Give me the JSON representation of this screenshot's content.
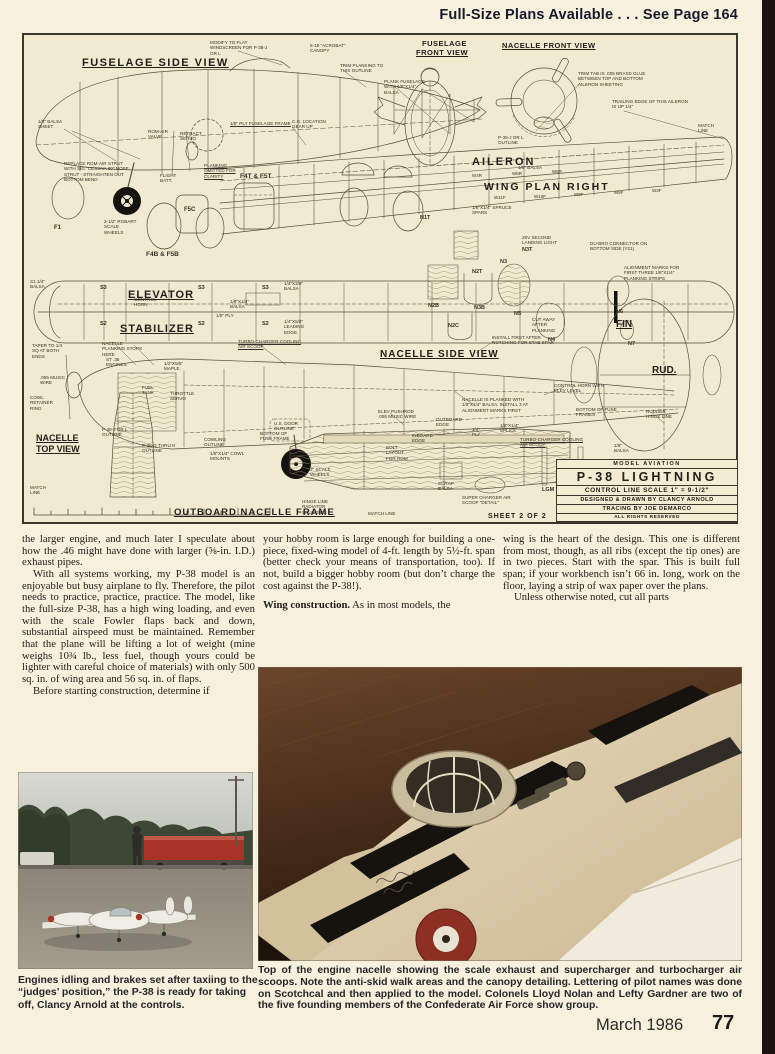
{
  "header": {
    "note": "Full-Size Plans Available . . . See Page 164"
  },
  "footer": {
    "issue": "March 1986",
    "page_number": "77"
  },
  "colors": {
    "page_bg": "#f6f0dc",
    "plan_bg": "#f1ead0",
    "accent_red": "#a93227",
    "edge_bar": "#1a120e",
    "ink": "#23201a"
  },
  "plan": {
    "sheet_label": "SHEET 2 OF 2",
    "title_block": {
      "magazine": "MODEL AVIATION",
      "model": "P-38 LIGHTNING",
      "scale": "CONTROL LINE SCALE  1\" = 9-1/2\"",
      "designer": "DESIGNED & DRAWN BY CLANCY ARNOLD",
      "tracing": "TRACING BY JOE DEMARCO",
      "rights": "ALL RIGHTS RESERVED"
    },
    "titles": [
      {
        "t": "FUSELAGE SIDE VIEW",
        "x": 58,
        "y": 22,
        "fs": 11,
        "u": 1,
        "ls": 1.5
      },
      {
        "t": "FUSELAGE",
        "x": 398,
        "y": 4,
        "fs": 7.5,
        "ls": 0.5
      },
      {
        "t": "FRONT VIEW",
        "x": 392,
        "y": 13,
        "fs": 7.5,
        "u": 1,
        "ls": 0.5
      },
      {
        "t": "NACELLE FRONT VIEW",
        "x": 478,
        "y": 6,
        "fs": 7.5,
        "u": 1,
        "ls": 0.5
      },
      {
        "t": "AILERON",
        "x": 448,
        "y": 121,
        "fs": 11,
        "ls": 2
      },
      {
        "t": "WING    PLAN    RIGHT",
        "x": 460,
        "y": 146,
        "fs": 10.5,
        "ls": 2
      },
      {
        "t": "ELEVATOR",
        "x": 104,
        "y": 254,
        "fs": 11,
        "u": 1,
        "ls": 1
      },
      {
        "t": "STABILIZER",
        "x": 96,
        "y": 288,
        "fs": 11,
        "u": 1,
        "ls": 1
      },
      {
        "t": "NACELLE SIDE VIEW",
        "x": 356,
        "y": 314,
        "fs": 10,
        "u": 1,
        "ls": 1
      },
      {
        "t": "FIN",
        "x": 592,
        "y": 284,
        "fs": 10,
        "u": 1
      },
      {
        "t": "RUD.",
        "x": 628,
        "y": 330,
        "fs": 10,
        "u": 1
      },
      {
        "t": "NACELLE",
        "x": 12,
        "y": 398,
        "fs": 9,
        "u": 1
      },
      {
        "t": "TOP VIEW",
        "x": 12,
        "y": 409,
        "fs": 9,
        "u": 1
      },
      {
        "t": "OUTBOARD NACELLE FRAME",
        "x": 150,
        "y": 472,
        "fs": 9.5,
        "u": 1,
        "ls": 1
      }
    ],
    "notes": [
      {
        "t": "1/8\" BALSA SHEET",
        "x": 14,
        "y": 84,
        "w": 34
      },
      {
        "t": "MODIFY TO FLAT WINDSCREEN FOR P-38-J OR L",
        "x": 186,
        "y": 5,
        "w": 62
      },
      {
        "t": "5-16 \"ACROBAT\" CANOPY",
        "x": 286,
        "y": 8,
        "w": 44
      },
      {
        "t": "TRIM PLANKING TO THIS OUTLINE",
        "x": 316,
        "y": 28,
        "w": 48
      },
      {
        "t": "PLANK FUSELAGE WITH 1/8\"x1/4\" BALSA",
        "x": 360,
        "y": 44,
        "w": 44
      },
      {
        "t": "ROM-AIR VALVE",
        "x": 124,
        "y": 94,
        "w": 26
      },
      {
        "t": "RETRACT SERVO",
        "x": 156,
        "y": 96,
        "w": 26
      },
      {
        "t": "1/8\" PLY FUSELAGE FRAME",
        "x": 206,
        "y": 86,
        "w": 80,
        "u": 1
      },
      {
        "t": "C.G. LOCATION GEAR UP",
        "x": 268,
        "y": 84,
        "w": 34
      },
      {
        "t": "REPLACE ROM-AIR STRUT WITH SIG \"CESSNA 60\" NOSE STRUT - STRAIGHTEN OUT BOTTOM BEND",
        "x": 40,
        "y": 126,
        "w": 66
      },
      {
        "t": "PLANKING OMITTED FOR CLARITY",
        "x": 180,
        "y": 128,
        "w": 44,
        "u": 1
      },
      {
        "t": "FLIGHT BATT.",
        "x": 136,
        "y": 138,
        "w": 22
      },
      {
        "t": "2-1/2\" ROBART SCALE WHEELS",
        "x": 80,
        "y": 184,
        "w": 34
      },
      {
        "t": "F4T & F5T",
        "x": 216,
        "y": 138,
        "fs": 6.5,
        "b": 1
      },
      {
        "t": "F4B & F5B",
        "x": 122,
        "y": 216,
        "fs": 6.5,
        "b": 1
      },
      {
        "t": "F5C",
        "x": 160,
        "y": 172,
        "fs": 6,
        "b": 1
      },
      {
        "t": "F1",
        "x": 30,
        "y": 190,
        "fs": 6,
        "b": 1
      },
      {
        "t": "TRIM TAB IS .005 BRASS GLUE BETWEEN TOP AND BOTTOM AILERON SHEETING",
        "x": 554,
        "y": 36,
        "w": 78
      },
      {
        "t": "TRAILING EDGE OF THIS AILERON IS UP 1/4\"",
        "x": 588,
        "y": 64,
        "w": 78
      },
      {
        "t": "MATCH LINE",
        "x": 674,
        "y": 88,
        "w": 26
      },
      {
        "t": "P-38-J OR L OUTLINE",
        "x": 474,
        "y": 100,
        "w": 40
      },
      {
        "t": "1/8\" BALSA",
        "x": 494,
        "y": 130,
        "w": 30
      },
      {
        "t": "1/8\"x1/4\" SPRUCE SPARS",
        "x": 448,
        "y": 170,
        "w": 40
      },
      {
        "t": "25V SECOND LANDING LIGHT",
        "x": 498,
        "y": 200,
        "w": 44
      },
      {
        "t": "DU-BRO CONNECTOR ON BOTTOM SIDE (Y21)",
        "x": 566,
        "y": 206,
        "w": 62
      },
      {
        "t": "ALIGNMENT MARKS FOR FIRST THREE 1/8\"x1/4\" PLANKING STRIPS",
        "x": 600,
        "y": 230,
        "w": 58
      },
      {
        "t": "TAPER TO 1/4 SQ AT BOTH ENDS",
        "x": 8,
        "y": 308,
        "w": 38
      },
      {
        "t": ".055 MUSIC WIRE",
        "x": 16,
        "y": 340,
        "w": 26
      },
      {
        "t": "COWL RETAINER RING",
        "x": 6,
        "y": 360,
        "w": 30
      },
      {
        "t": "NACELLE PLANKING STOPS HERE",
        "x": 78,
        "y": 306,
        "w": 40
      },
      {
        "t": "TURBO-CHARGER COOLING AIR SCOOP",
        "x": 214,
        "y": 304,
        "w": 66,
        "u": 1
      },
      {
        "t": "TURBO-CHARGER COOLING AIR SCOOP",
        "x": 496,
        "y": 402,
        "w": 70,
        "u": 1
      },
      {
        "t": "ST .35 ENGINES",
        "x": 82,
        "y": 322,
        "w": 24
      },
      {
        "t": "1/2\"x5/8\" MAPLE",
        "x": 140,
        "y": 326,
        "w": 30
      },
      {
        "t": "FUEL TANK",
        "x": 118,
        "y": 350,
        "w": 24
      },
      {
        "t": "THROTTLE SERVO",
        "x": 146,
        "y": 356,
        "w": 28
      },
      {
        "t": "U.S. DOOR OUTLINE",
        "x": 250,
        "y": 386,
        "w": 30
      },
      {
        "t": "P-38-J OR L OUTLINE",
        "x": 78,
        "y": 392,
        "w": 36
      },
      {
        "t": "P-38-G THRU H OUTLINE",
        "x": 118,
        "y": 408,
        "w": 40
      },
      {
        "t": "COWLING OUTLINE",
        "x": 180,
        "y": 402,
        "w": 30
      },
      {
        "t": "1/8\"x1/4\" COWL MOUNTS",
        "x": 186,
        "y": 416,
        "w": 34
      },
      {
        "t": "BOTTOM OF FUSE FRAME",
        "x": 236,
        "y": 396,
        "w": 36
      },
      {
        "t": "NACELLE IS PLANKED WITH 1/8\"x1/4\" BALSA. INSTALL 3 AT ALIGNMENT MARKS FIRST",
        "x": 438,
        "y": 362,
        "w": 72
      },
      {
        "t": "INSTALL FIRST AFTER NOTCHING FOR STAB SPAR",
        "x": 468,
        "y": 300,
        "w": 62
      },
      {
        "t": "CONTROL HORN WITH ELEV LEVEL",
        "x": 530,
        "y": 348,
        "w": 52
      },
      {
        "t": "BOTTOM OF FUSE FRAMES",
        "x": 552,
        "y": 372,
        "w": 44
      },
      {
        "t": "RUDDER HINGE LINE",
        "x": 622,
        "y": 374,
        "w": 34
      },
      {
        "t": "ELEV PUSHROD .055 MUSIC WIRE",
        "x": 354,
        "y": 374,
        "w": 44
      },
      {
        "t": "INBOARD EDGE",
        "x": 388,
        "y": 398,
        "w": 26
      },
      {
        "t": "OUTBOARD EDGE",
        "x": 412,
        "y": 382,
        "w": 30
      },
      {
        "t": "BOLT LAYOUT FOR ROM",
        "x": 362,
        "y": 410,
        "w": 28
      },
      {
        "t": "1/4\" PLY",
        "x": 448,
        "y": 392,
        "w": 16
      },
      {
        "t": "1/8\"x1/4\" SPLICE",
        "x": 476,
        "y": 388,
        "w": 28
      },
      {
        "t": "1/8\" BALSA",
        "x": 590,
        "y": 408,
        "w": 24
      },
      {
        "t": "MATCH LINE",
        "x": 6,
        "y": 450,
        "w": 22
      },
      {
        "t": "SUPER CHARGER AIR SCOOP \"DETAIL\"",
        "x": 438,
        "y": 460,
        "w": 50
      },
      {
        "t": "SCRAP BALSA",
        "x": 414,
        "y": 446,
        "w": 24
      },
      {
        "t": "LGM",
        "x": 518,
        "y": 452,
        "fs": 5.5,
        "b": 1
      },
      {
        "t": "NGM",
        "x": 554,
        "y": 452,
        "fs": 5.5,
        "b": 1
      },
      {
        "t": "HINGE LINE RADIATOR SHUTTERS",
        "x": 278,
        "y": 464,
        "w": 46
      },
      {
        "t": "MATCH LINE",
        "x": 344,
        "y": 476,
        "w": 30
      },
      {
        "t": "3\" SCALE WHEELS",
        "x": 286,
        "y": 432,
        "w": 26
      },
      {
        "t": "S1 1/4\" BALSA",
        "x": 6,
        "y": 244,
        "w": 22
      },
      {
        "t": "S3",
        "x": 76,
        "y": 250,
        "fs": 5.5,
        "b": 1
      },
      {
        "t": "S2",
        "x": 76,
        "y": 286,
        "fs": 5.5,
        "b": 1
      },
      {
        "t": "S3",
        "x": 174,
        "y": 250,
        "fs": 5.5,
        "b": 1
      },
      {
        "t": "S2",
        "x": 174,
        "y": 286,
        "fs": 5.5,
        "b": 1
      },
      {
        "t": "S3",
        "x": 238,
        "y": 250,
        "fs": 5.5,
        "b": 1
      },
      {
        "t": "S2",
        "x": 238,
        "y": 286,
        "fs": 5.5,
        "b": 1
      },
      {
        "t": "1/4\"x3/8\" BALSA",
        "x": 260,
        "y": 246,
        "w": 30
      },
      {
        "t": "1/4\"x5/8\" LEADING EDGE",
        "x": 260,
        "y": 284,
        "w": 30
      },
      {
        "t": "1/8\"x1/4\" BALSA",
        "x": 206,
        "y": 264,
        "w": 28
      },
      {
        "t": "1/8\" PLY",
        "x": 192,
        "y": 278,
        "w": 18
      },
      {
        "t": "CONTROL HORN",
        "x": 110,
        "y": 262,
        "w": 26
      },
      {
        "t": "CUT AWAY AFTER PLANKING",
        "x": 508,
        "y": 282,
        "w": 34
      },
      {
        "t": "N1T",
        "x": 396,
        "y": 180,
        "fs": 5.5,
        "b": 1
      },
      {
        "t": "N2T",
        "x": 448,
        "y": 234,
        "fs": 5.5,
        "b": 1
      },
      {
        "t": "N3T",
        "x": 498,
        "y": 212,
        "fs": 5.5,
        "b": 1
      },
      {
        "t": "N3",
        "x": 476,
        "y": 224,
        "fs": 5.5,
        "b": 1
      },
      {
        "t": "N3B",
        "x": 450,
        "y": 270,
        "fs": 5.5,
        "b": 1
      },
      {
        "t": "N5",
        "x": 490,
        "y": 276,
        "fs": 5.5,
        "b": 1
      },
      {
        "t": "N4",
        "x": 524,
        "y": 302,
        "fs": 5.5,
        "b": 1
      },
      {
        "t": "N6",
        "x": 592,
        "y": 274,
        "fs": 5.5,
        "b": 1
      },
      {
        "t": "N7",
        "x": 604,
        "y": 306,
        "fs": 5.5,
        "b": 1
      },
      {
        "t": "N2C",
        "x": 424,
        "y": 288,
        "fs": 5.5,
        "b": 1
      },
      {
        "t": "N2B",
        "x": 404,
        "y": 268,
        "fs": 5.5,
        "b": 1
      },
      {
        "t": "W4R",
        "x": 448,
        "y": 138,
        "fs": 4.5
      },
      {
        "t": "W5R",
        "x": 488,
        "y": 136,
        "fs": 4.5
      },
      {
        "t": "W6R",
        "x": 528,
        "y": 134,
        "fs": 4.5
      },
      {
        "t": "W11F",
        "x": 470,
        "y": 160,
        "fs": 4.5
      },
      {
        "t": "W10F",
        "x": 510,
        "y": 159,
        "fs": 4.5
      },
      {
        "t": "W9F",
        "x": 550,
        "y": 157,
        "fs": 4.5
      },
      {
        "t": "W5F",
        "x": 590,
        "y": 155,
        "fs": 4.5
      },
      {
        "t": "W3F",
        "x": 628,
        "y": 153,
        "fs": 4.5
      }
    ]
  },
  "article": {
    "col1": [
      "the larger engine, and much later I speculate about how the .46 might have done with larger (⅝-in. I.D.) exhaust pipes.",
      "With all systems working, my P-38 model is an enjoyable but busy airplane to fly. Therefore, the pilot needs to practice, practice, practice. The model, like the full-size P-38, has a high wing loading, and even with the scale Fowler flaps back and down, substantial airspeed must be maintained. Remember that the plane will be lifting a lot of weight (mine weighs 10¾ lb., less fuel, though yours could be lighter with careful choice of materials) with only 500 sq. in. of wing area and 56 sq. in. of flaps.",
      "Before starting construction, determine if"
    ],
    "col2": [
      "your hobby room is large enough for building a one-piece, fixed-wing model of 4-ft. length by 5½-ft. span (better check your means of transportation, too). If not, build a bigger hobby room (but don’t charge the cost against the P-38!)."
    ],
    "col2_heading": "Wing construction.",
    "col2_heading_rest": " As in most models, the",
    "col3": [
      "wing is the heart of the design. This one is different from most, though, as all ribs (except the tip ones) are in two pieces. Start with the spar. This is built full span; if your workbench isn’t 66 in. long, work on the floor, laying a strip of wax paper over the plans.",
      "Unless otherwise noted, cut all parts"
    ]
  },
  "captions": {
    "left": "Engines idling and brakes set after taxiing to the “judges’ position,” the P-38 is ready for taking off, Clancy Arnold at the controls.",
    "right": "Top of the engine nacelle showing the scale exhaust and supercharger and turbocharger air scoops. Note the anti-skid walk areas and the canopy detailing. Lettering of pilot names was done on Scotchcal and then applied to the model. Colonels Lloyd Nolan and Lefty Gardner are two of the five founding members of the Confederate Air Force show group."
  }
}
